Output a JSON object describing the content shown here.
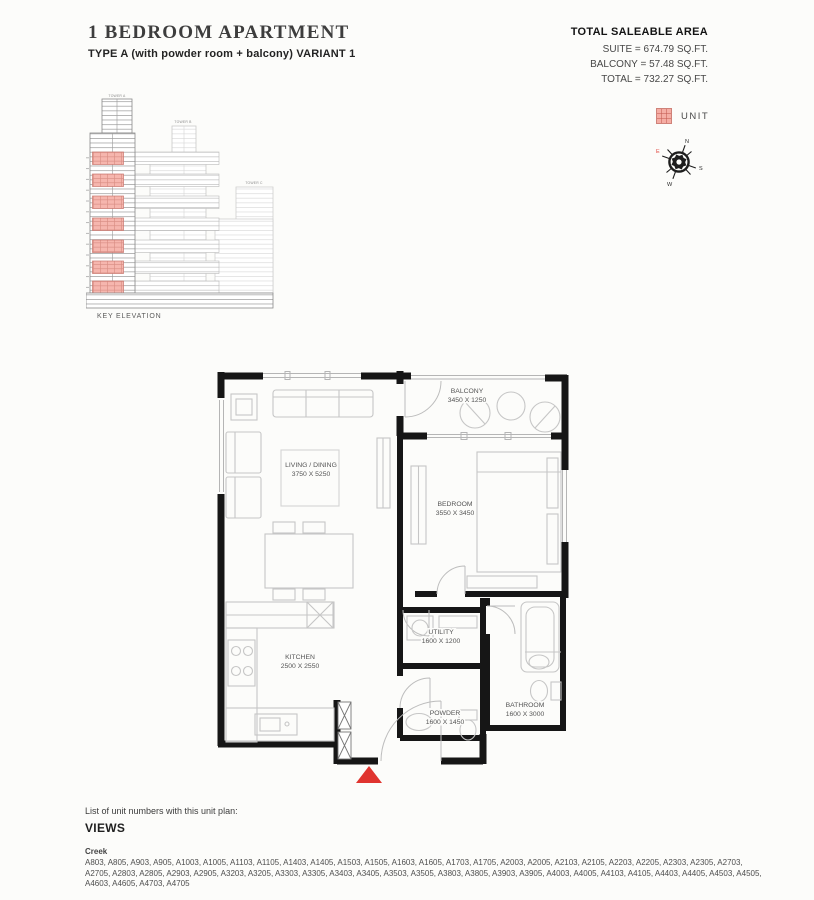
{
  "header": {
    "title": "1 BEDROOM APARTMENT",
    "subtitle": "TYPE A (with powder room + balcony) VARIANT 1"
  },
  "saleable_area": {
    "heading": "TOTAL SALEABLE AREA",
    "suite": "SUITE = 674.79 SQ.FT.",
    "balcony": "BALCONY = 57.48 SQ.FT.",
    "total": "TOTAL = 732.27 SQ.FT."
  },
  "legend": {
    "unit_label": "UNIT",
    "unit_color": "#f5ada4"
  },
  "compass": {
    "n": "N",
    "e": "E",
    "s": "S",
    "w": "W"
  },
  "key_elevation": {
    "caption": "KEY ELEVATION",
    "towers": [
      "TOWER A",
      "TOWER B",
      "TOWER C"
    ]
  },
  "floor_plan": {
    "entrance_marker_color": "#e0342f",
    "rooms": [
      {
        "name": "LIVING / DINING",
        "dims": "3750 X 5250"
      },
      {
        "name": "BALCONY",
        "dims": "3450 X 1250"
      },
      {
        "name": "BEDROOM",
        "dims": "3550 X 3450"
      },
      {
        "name": "KITCHEN",
        "dims": "2500 X 2550"
      },
      {
        "name": "UTILITY",
        "dims": "1600 X 1200"
      },
      {
        "name": "POWDER",
        "dims": "1600 X 1450"
      },
      {
        "name": "BATHROOM",
        "dims": "1600 X 3000"
      }
    ]
  },
  "unit_list": {
    "intro": "List of unit numbers with this unit plan:",
    "heading": "VIEWS",
    "group": "Creek",
    "units": "A803, A805, A903, A905, A1003, A1005, A1103, A1105, A1403, A1405, A1503, A1505, A1603, A1605, A1703, A1705, A2003, A2005, A2103, A2105, A2203, A2205, A2303, A2305, A2703, A2705, A2803, A2805, A2903, A2905, A3203, A3205, A3303, A3305, A3403, A3405, A3503, A3505, A3803, A3805, A3903, A3905, A4003, A4005, A4103, A4105, A4403, A4405, A4503, A4505, A4603, A4605, A4703, A4705"
  }
}
